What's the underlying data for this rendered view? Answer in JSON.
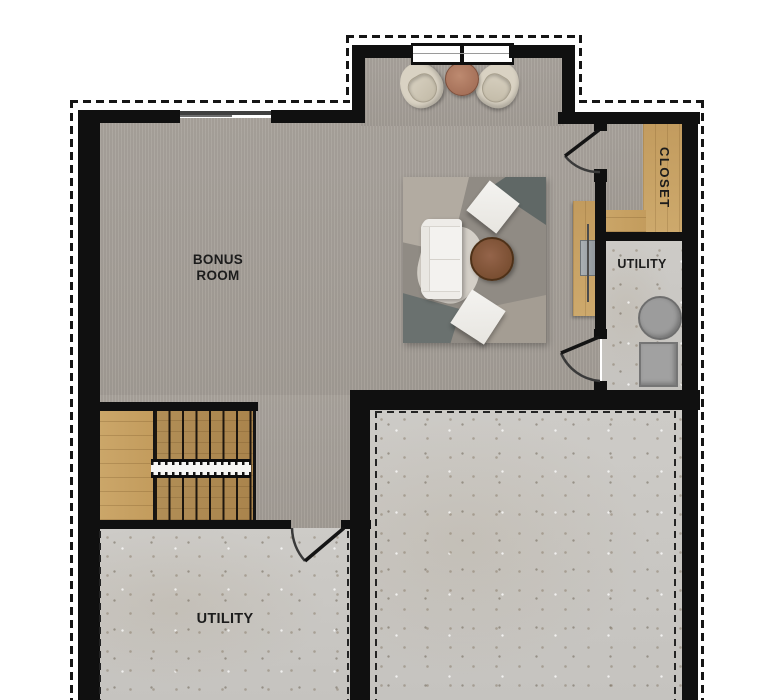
{
  "rooms": {
    "bonus": {
      "line1": "BONUS",
      "line2": "ROOM",
      "floor": "carpet"
    },
    "closet": {
      "label": "CLOSET",
      "floor": "carpet-with-wood-shelving"
    },
    "utility_right": {
      "label": "UTILITY",
      "floor": "concrete"
    },
    "utility_lower": {
      "label": "UTILITY",
      "floor": "concrete"
    },
    "unfinished_area": {
      "label": "",
      "floor": "concrete"
    }
  },
  "colors": {
    "background": "#ffffff",
    "wall": "#101010",
    "carpet": "#a7a19a",
    "concrete": "#cbc9c5",
    "wood": "#c9a265",
    "rug_base": "#908b84",
    "upholstery_white": "#f3f2ef",
    "chair_cream": "#d9d2c3",
    "coffee_table_walnut": "#7a4e2f",
    "side_table_clay": "#b17b61",
    "equipment_gray": "#9c9c9c"
  },
  "furniture": {
    "bump_out": [
      "barrel-chair",
      "round-side-table",
      "barrel-chair"
    ],
    "bonus_room": [
      "area-rug",
      "sofa",
      "round-coffee-table",
      "floor-cushion",
      "floor-cushion",
      "desk-with-laptop"
    ],
    "utility_right": [
      "water-heater",
      "furnace"
    ],
    "stairs": {
      "flights": 2,
      "landing": true,
      "railing": true
    }
  },
  "annotations": {
    "exterior_outline": "dashed",
    "doors": [
      "closet-door",
      "utility-right-door",
      "utility-lower-door"
    ],
    "window": "double-pane-top"
  }
}
